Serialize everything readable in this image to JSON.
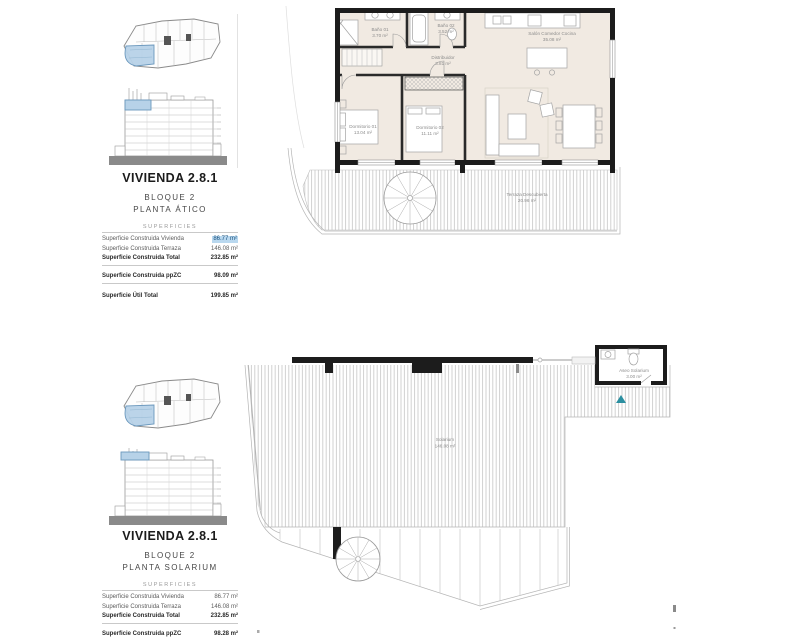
{
  "sections": [
    {
      "title": "VIVIENDA 2.8.1",
      "block": "BLOQUE 2",
      "floor": "PLANTA ÁTICO",
      "surfaces_header": "SUPERFICIES",
      "rows": [
        {
          "label": "Superficie Construida Vivienda",
          "value": "86.77 m²"
        },
        {
          "label": "Superficie Construida Terraza",
          "value": "146.08 m²"
        },
        {
          "label": "Superficie Construida Total",
          "value": "232.85 m²"
        },
        {
          "label": "Superficie Construida ppZC",
          "value": "98.09 m²"
        },
        {
          "label": "Superficie Útil Total",
          "value": "199.85 m²"
        }
      ]
    },
    {
      "title": "VIVIENDA 2.8.1",
      "block": "BLOQUE 2",
      "floor": "PLANTA SOLARIUM",
      "surfaces_header": "SUPERFICIES",
      "rows": [
        {
          "label": "Superficie Construida Vivienda",
          "value": "86.77 m²"
        },
        {
          "label": "Superficie Construida Terraza",
          "value": "146.08 m²"
        },
        {
          "label": "Superficie Construida Total",
          "value": "232.85 m²"
        },
        {
          "label": "Superficie Construida ppZC",
          "value": "98.28 m²"
        },
        {
          "label": "Superficie Útil Total",
          "value": "190.85 m²"
        }
      ]
    }
  ],
  "plan_atico": {
    "bano1_name": "Baño 01",
    "bano1_area": "3.70 m²",
    "bano2_name": "Baño 02",
    "bano2_area": "3.52 m²",
    "distribuidor_name": "Distribuidor",
    "distribuidor_area": "3.81 m²",
    "salon_name": "Salón Comedor Cocina",
    "salon_area": "35.08 m²",
    "dorm1_name": "Dormitorio 01",
    "dorm1_area": "13.04 m²",
    "dorm2_name": "Dormitorio 02",
    "dorm2_area": "11.11 m²",
    "terraza_name": "Terraza Descubierta",
    "terraza_area": "20.96 m²"
  },
  "plan_solarium": {
    "solarium_name": "Solarium",
    "solarium_area": "146.08 m²",
    "aseo_name": "Aseo Solarium",
    "aseo_area": "3.00 m²"
  },
  "palette": {
    "wall": "#1c1c1c",
    "interior": "#f1eae2",
    "highlight_bg": "#b9d8ef",
    "unit_fill": "#b7d2e8",
    "teal": "#2b8fa0"
  }
}
